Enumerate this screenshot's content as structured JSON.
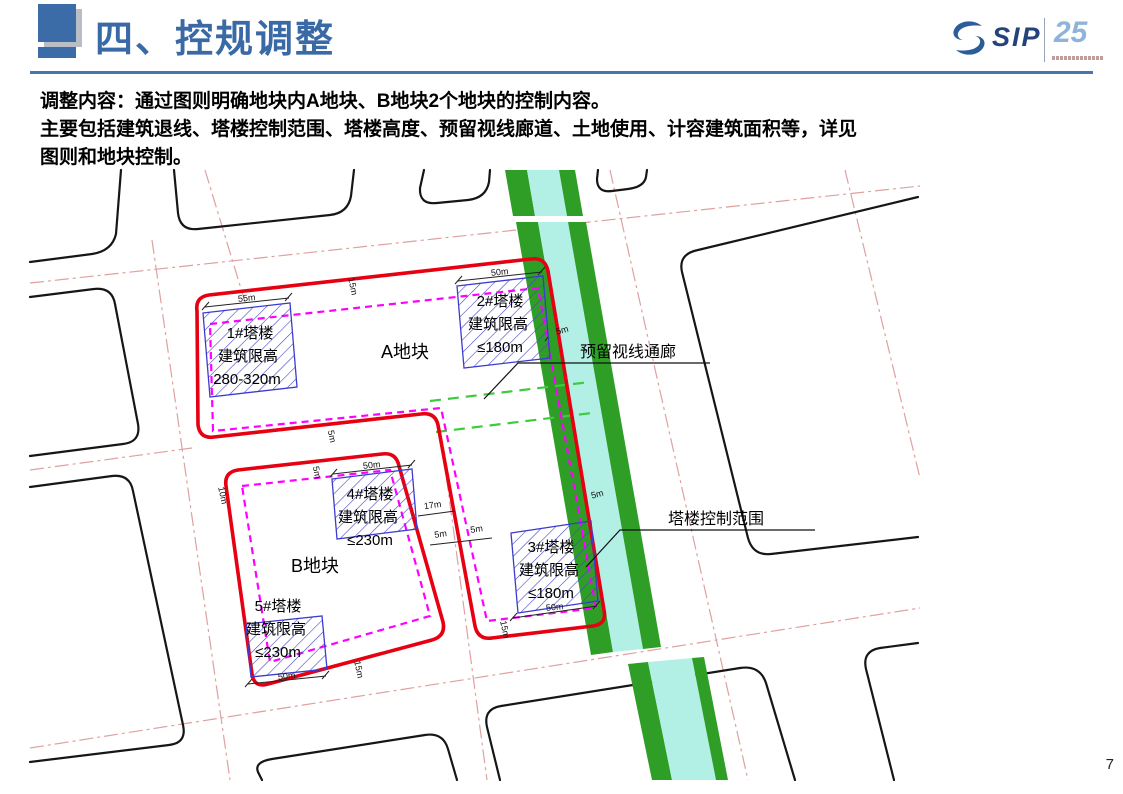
{
  "header": {
    "title": "四、控规调整",
    "logo": {
      "brand": "SIP",
      "anniversary": "25"
    }
  },
  "body": {
    "line1": "调整内容：通过图则明确地块内A地块、B地块2个地块的控制内容。",
    "line2": "主要包括建筑退线、塔楼控制范围、塔楼高度、预留视线廊道、土地使用、计容建筑面积等，详见",
    "line3": "图则和地块控制。"
  },
  "map": {
    "plot_a": "A地块",
    "plot_b": "B地块",
    "towers": {
      "t1": {
        "l1": "1#塔楼",
        "l2": "建筑限高",
        "l3": "280-320m"
      },
      "t2": {
        "l1": "2#塔楼",
        "l2": "建筑限高",
        "l3": "≤180m"
      },
      "t3": {
        "l1": "3#塔楼",
        "l2": "建筑限高",
        "l3": "≤180m"
      },
      "t4": {
        "l1": "4#塔楼",
        "l2": "建筑限高",
        "l3": "≤230m"
      },
      "t5": {
        "l1": "5#塔楼",
        "l2": "建筑限高",
        "l3": "≤230m"
      }
    },
    "callouts": {
      "view_corridor": "预留视线通廊",
      "tower_zone": "塔楼控制范围"
    },
    "dims": {
      "d55": "55m",
      "d50": "50m",
      "d17": "17m",
      "d15": "15m",
      "d10": "10m",
      "d5": "5m"
    },
    "legend_colors": {
      "plot_boundary": "#e60012",
      "tower_control_line": "#ff00ff",
      "green_belt": "#2f9e26",
      "canal": "#b2f0e6",
      "view_corridor_line": "#3ecb3e"
    }
  },
  "footer": {
    "page_number": "7"
  }
}
